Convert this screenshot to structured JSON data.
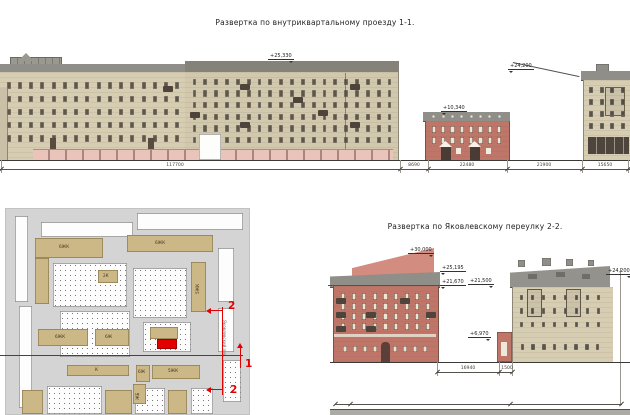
{
  "drawing": {
    "elevation_1": {
      "title": "Развертка по внутриквартальному проезду 1-1.",
      "marks": {
        "main_building_roof": "+25,330",
        "small_building_roof": "+10,340",
        "right_building_roof": "+24,200"
      },
      "dimensions": [
        "117700",
        "8690",
        "22480",
        "21900",
        "15650"
      ]
    },
    "elevation_2": {
      "title": "Развертка по Яковлевскому переулку 2-2.",
      "marks": {
        "tower_top": "+30,000",
        "left_roof_upper": "+25,195",
        "left_cornice": "+21,670",
        "right_roof": "+21,500",
        "annex_roof": "+6,970",
        "right_edge": "+24,200"
      },
      "dimensions": [
        "16940",
        "1500"
      ]
    },
    "site_plan": {
      "building_labels": [
        "6ЖК",
        "6ЖК",
        "2К",
        "5ЖК",
        "6ЖК",
        "6Ж",
        "6Ж",
        "К",
        "5ЖК",
        "ЖБ"
      ],
      "street_label": "Яковлевский пер.",
      "section_marks": {
        "section_1": "1",
        "section_2": "2"
      }
    },
    "colors": {
      "facade_beige": "#d7cdb3",
      "facade_beige2": "#d2c8ad",
      "facade_red": "#bf7568",
      "roof_gray": "#908e88",
      "base_pink": "#eac3ba",
      "plan_bg": "#d4d4d4",
      "plan_tan": "#ccb786",
      "section_red": "#e30000",
      "gable_pink": "#d28c80"
    }
  }
}
